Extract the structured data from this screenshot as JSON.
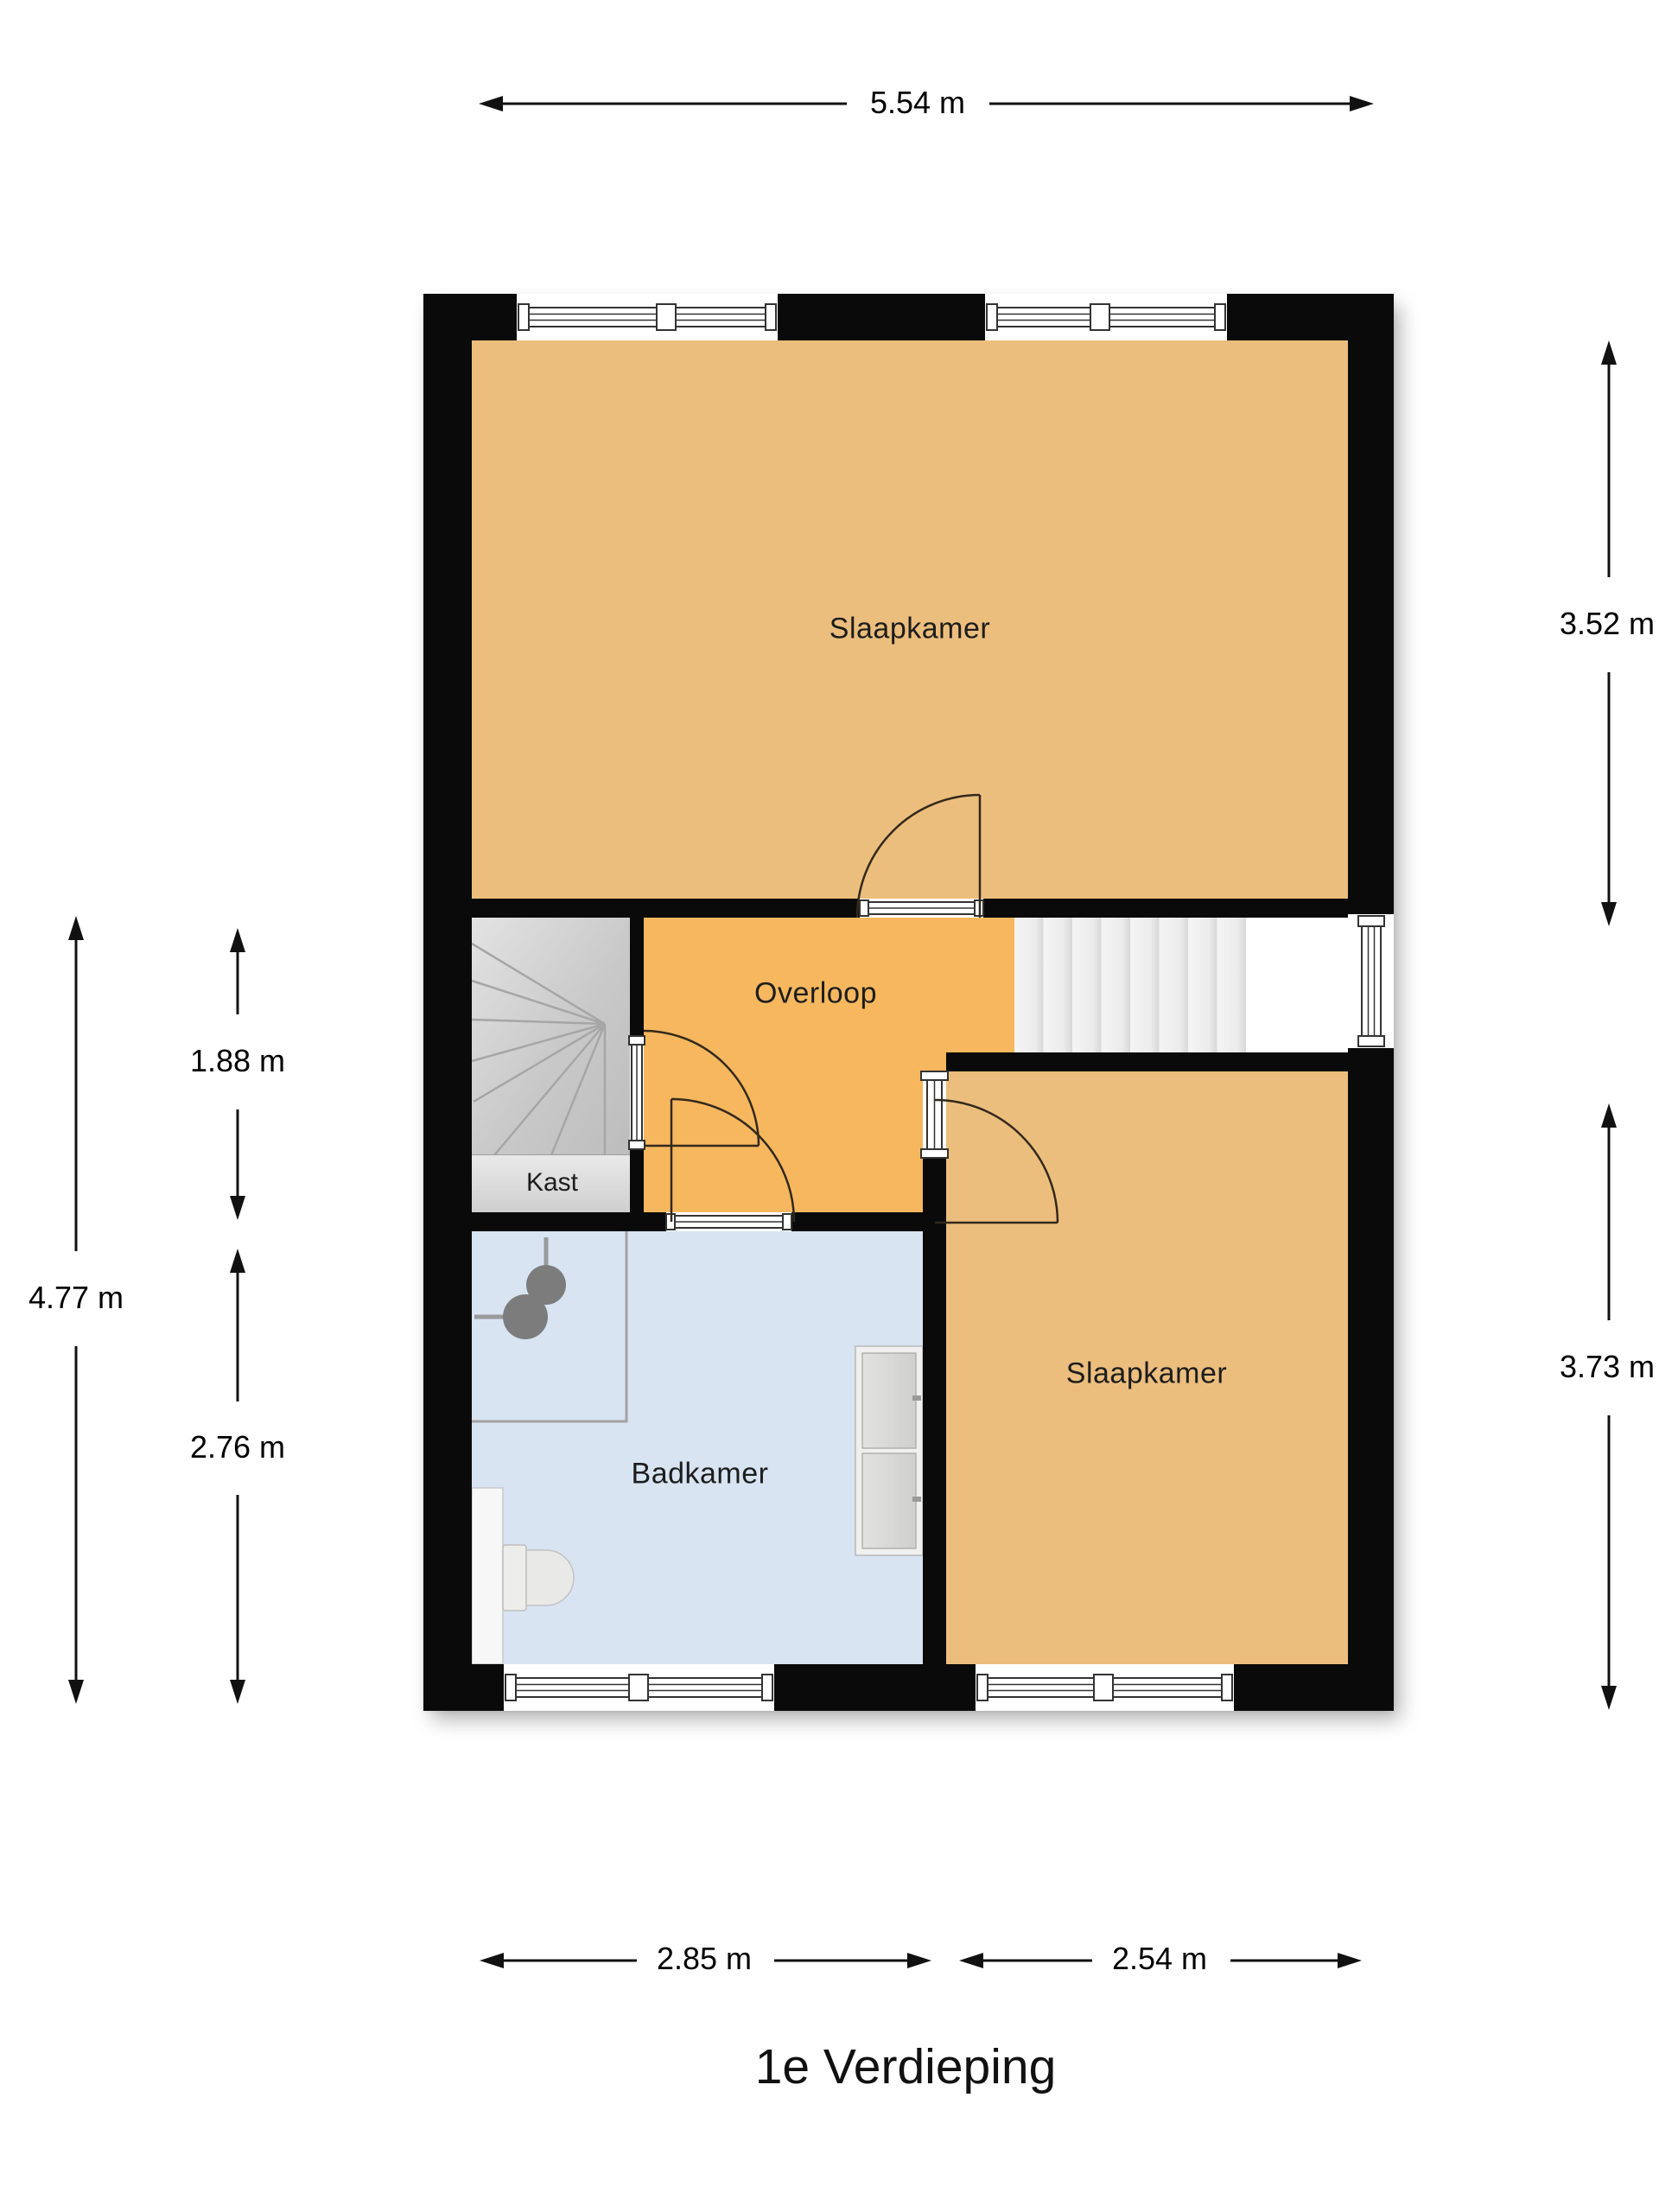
{
  "title": "1e Verdieping",
  "rooms": {
    "bedroom_top": "Slaapkamer",
    "landing": "Overloop",
    "closet": "Kast",
    "bathroom": "Badkamer",
    "bedroom_right": "Slaapkamer"
  },
  "dimensions": {
    "top_width": "5.54 m",
    "right_top_height": "3.52 m",
    "right_bottom_height": "3.73 m",
    "left_total_height": "4.77 m",
    "left_upper_height": "1.88 m",
    "left_lower_height": "2.76 m",
    "bottom_left_width": "2.85 m",
    "bottom_right_width": "2.54 m"
  },
  "icons": {
    "shower": "shower-head-icon",
    "toilet": "toilet-icon",
    "cabinet": "storage-cabinet-icon",
    "stairs_winder": "winder-stairs-icon",
    "stairs_straight": "straight-stairs-icon",
    "window": "window-icon",
    "door": "door-swing-icon"
  },
  "colors": {
    "wall": "#0a0a0a",
    "bedroom_fill": "#ecbe7d",
    "landing_fill": "#f6b75e",
    "bathroom_fill": "#d8e4f2",
    "stairs_fill": "#c9c9c9",
    "closet_fill": "#d6d6d6",
    "dimension_line": "#111111"
  }
}
